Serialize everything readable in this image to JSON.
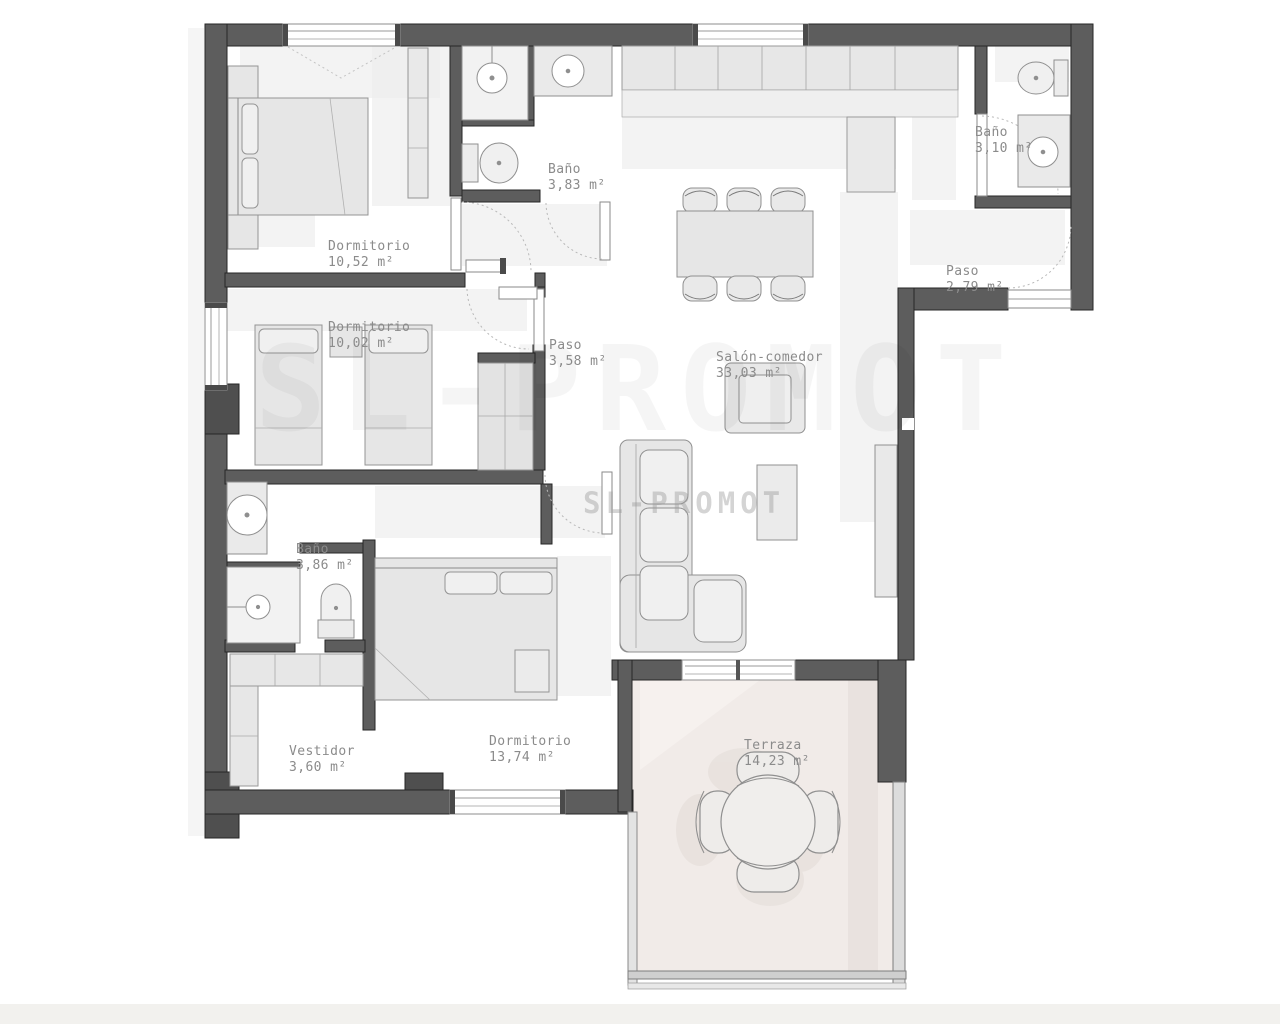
{
  "plan": {
    "watermark": {
      "text": "SL-PROMOT"
    },
    "rooms": [
      {
        "id": "dormitorio-1052",
        "name": "Dormitorio",
        "area": "10,52 m²"
      },
      {
        "id": "bano-383",
        "name": "Baño",
        "area": "3,83 m²"
      },
      {
        "id": "bano-310",
        "name": "Baño",
        "area": "3,10 m²"
      },
      {
        "id": "paso-279",
        "name": "Paso",
        "area": "2,79 m²"
      },
      {
        "id": "dormitorio-1002",
        "name": "Dormitorio",
        "area": "10,02 m²"
      },
      {
        "id": "paso-358",
        "name": "Paso",
        "area": "3,58 m²"
      },
      {
        "id": "salon-comedor",
        "name": "Salón-comedor",
        "area": "33,03 m²"
      },
      {
        "id": "bano-386",
        "name": "Baño",
        "area": "3,86 m²"
      },
      {
        "id": "vestidor-360",
        "name": "Vestidor",
        "area": "3,60 m²"
      },
      {
        "id": "dormitorio-1374",
        "name": "Dormitorio",
        "area": "13,74 m²"
      },
      {
        "id": "terraza-1423",
        "name": "Terraza",
        "area": "14,23 m²"
      }
    ],
    "colors": {
      "wall": "#5d5d5d",
      "wall_edge": "#262626",
      "furniture_fill": "#e7e7e7",
      "furniture_stroke": "#949494",
      "terrace_floor": "#f1ebe8",
      "label_text": "#8b8b8b"
    }
  }
}
